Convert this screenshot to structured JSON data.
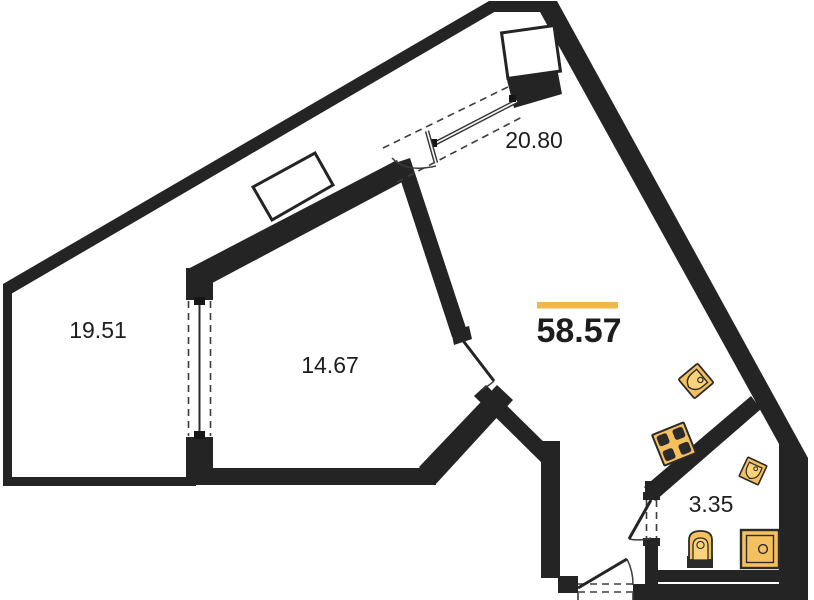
{
  "plan": {
    "kind": "apartment-floor-plan",
    "total_area": {
      "label": "58.57"
    },
    "rooms": {
      "terrace": {
        "area_label": "19.51"
      },
      "bedroom": {
        "area_label": "14.67"
      },
      "living": {
        "area_label": "20.80"
      },
      "bathroom": {
        "area_label": "3.35"
      }
    },
    "colors": {
      "wall": "#242424",
      "background": "#FFFFFF",
      "fixture_fill": "#F5C05E",
      "fixture_inner": "#F9D27A",
      "accent_bar": "#F2B64B",
      "label_text": "#1D1D1D"
    },
    "symbols": [
      "kitchen-sink",
      "stove-4-burner",
      "bathroom-sink",
      "toilet",
      "shower-washer-unit",
      "ventilation-shaft",
      "built-in-closet",
      "sliding-balcony-door",
      "window-partition",
      "interior-door",
      "bathroom-door",
      "entry-door"
    ]
  }
}
